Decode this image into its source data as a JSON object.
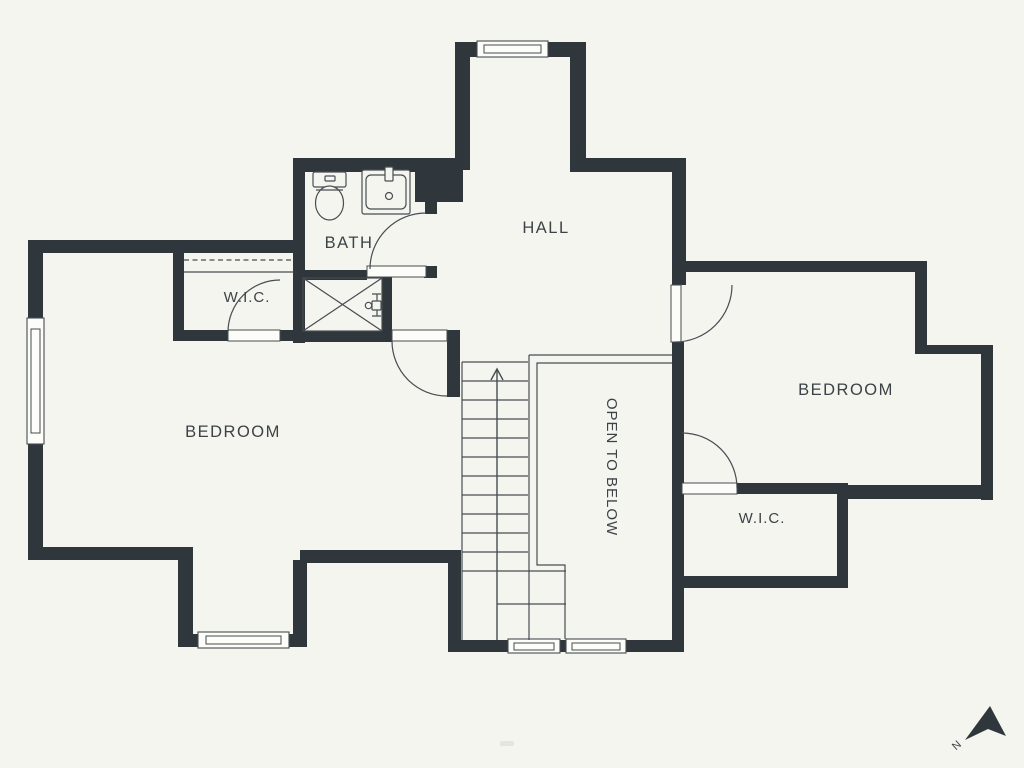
{
  "colors": {
    "background": "#f5f5ef",
    "wall": "#2f373c",
    "line": "#474d51",
    "text": "#3c4246",
    "window_fill": "#fcfcf8"
  },
  "rooms": [
    {
      "id": "hall",
      "label": "HALL"
    },
    {
      "id": "bath",
      "label": "BATH"
    },
    {
      "id": "wic-left",
      "label": "W.I.C."
    },
    {
      "id": "bedroom-left",
      "label": "BEDROOM"
    },
    {
      "id": "open-to-below",
      "label": "OPEN TO BELOW"
    },
    {
      "id": "bedroom-right",
      "label": "BEDROOM"
    },
    {
      "id": "wic-right",
      "label": "W.I.C."
    }
  ],
  "compass": {
    "label": "N"
  },
  "icons": [
    "toilet-icon",
    "sink-icon",
    "shower-icon",
    "stairs-up-arrow-icon",
    "north-arrow-icon",
    "window",
    "door-swing",
    "closet-rod"
  ]
}
